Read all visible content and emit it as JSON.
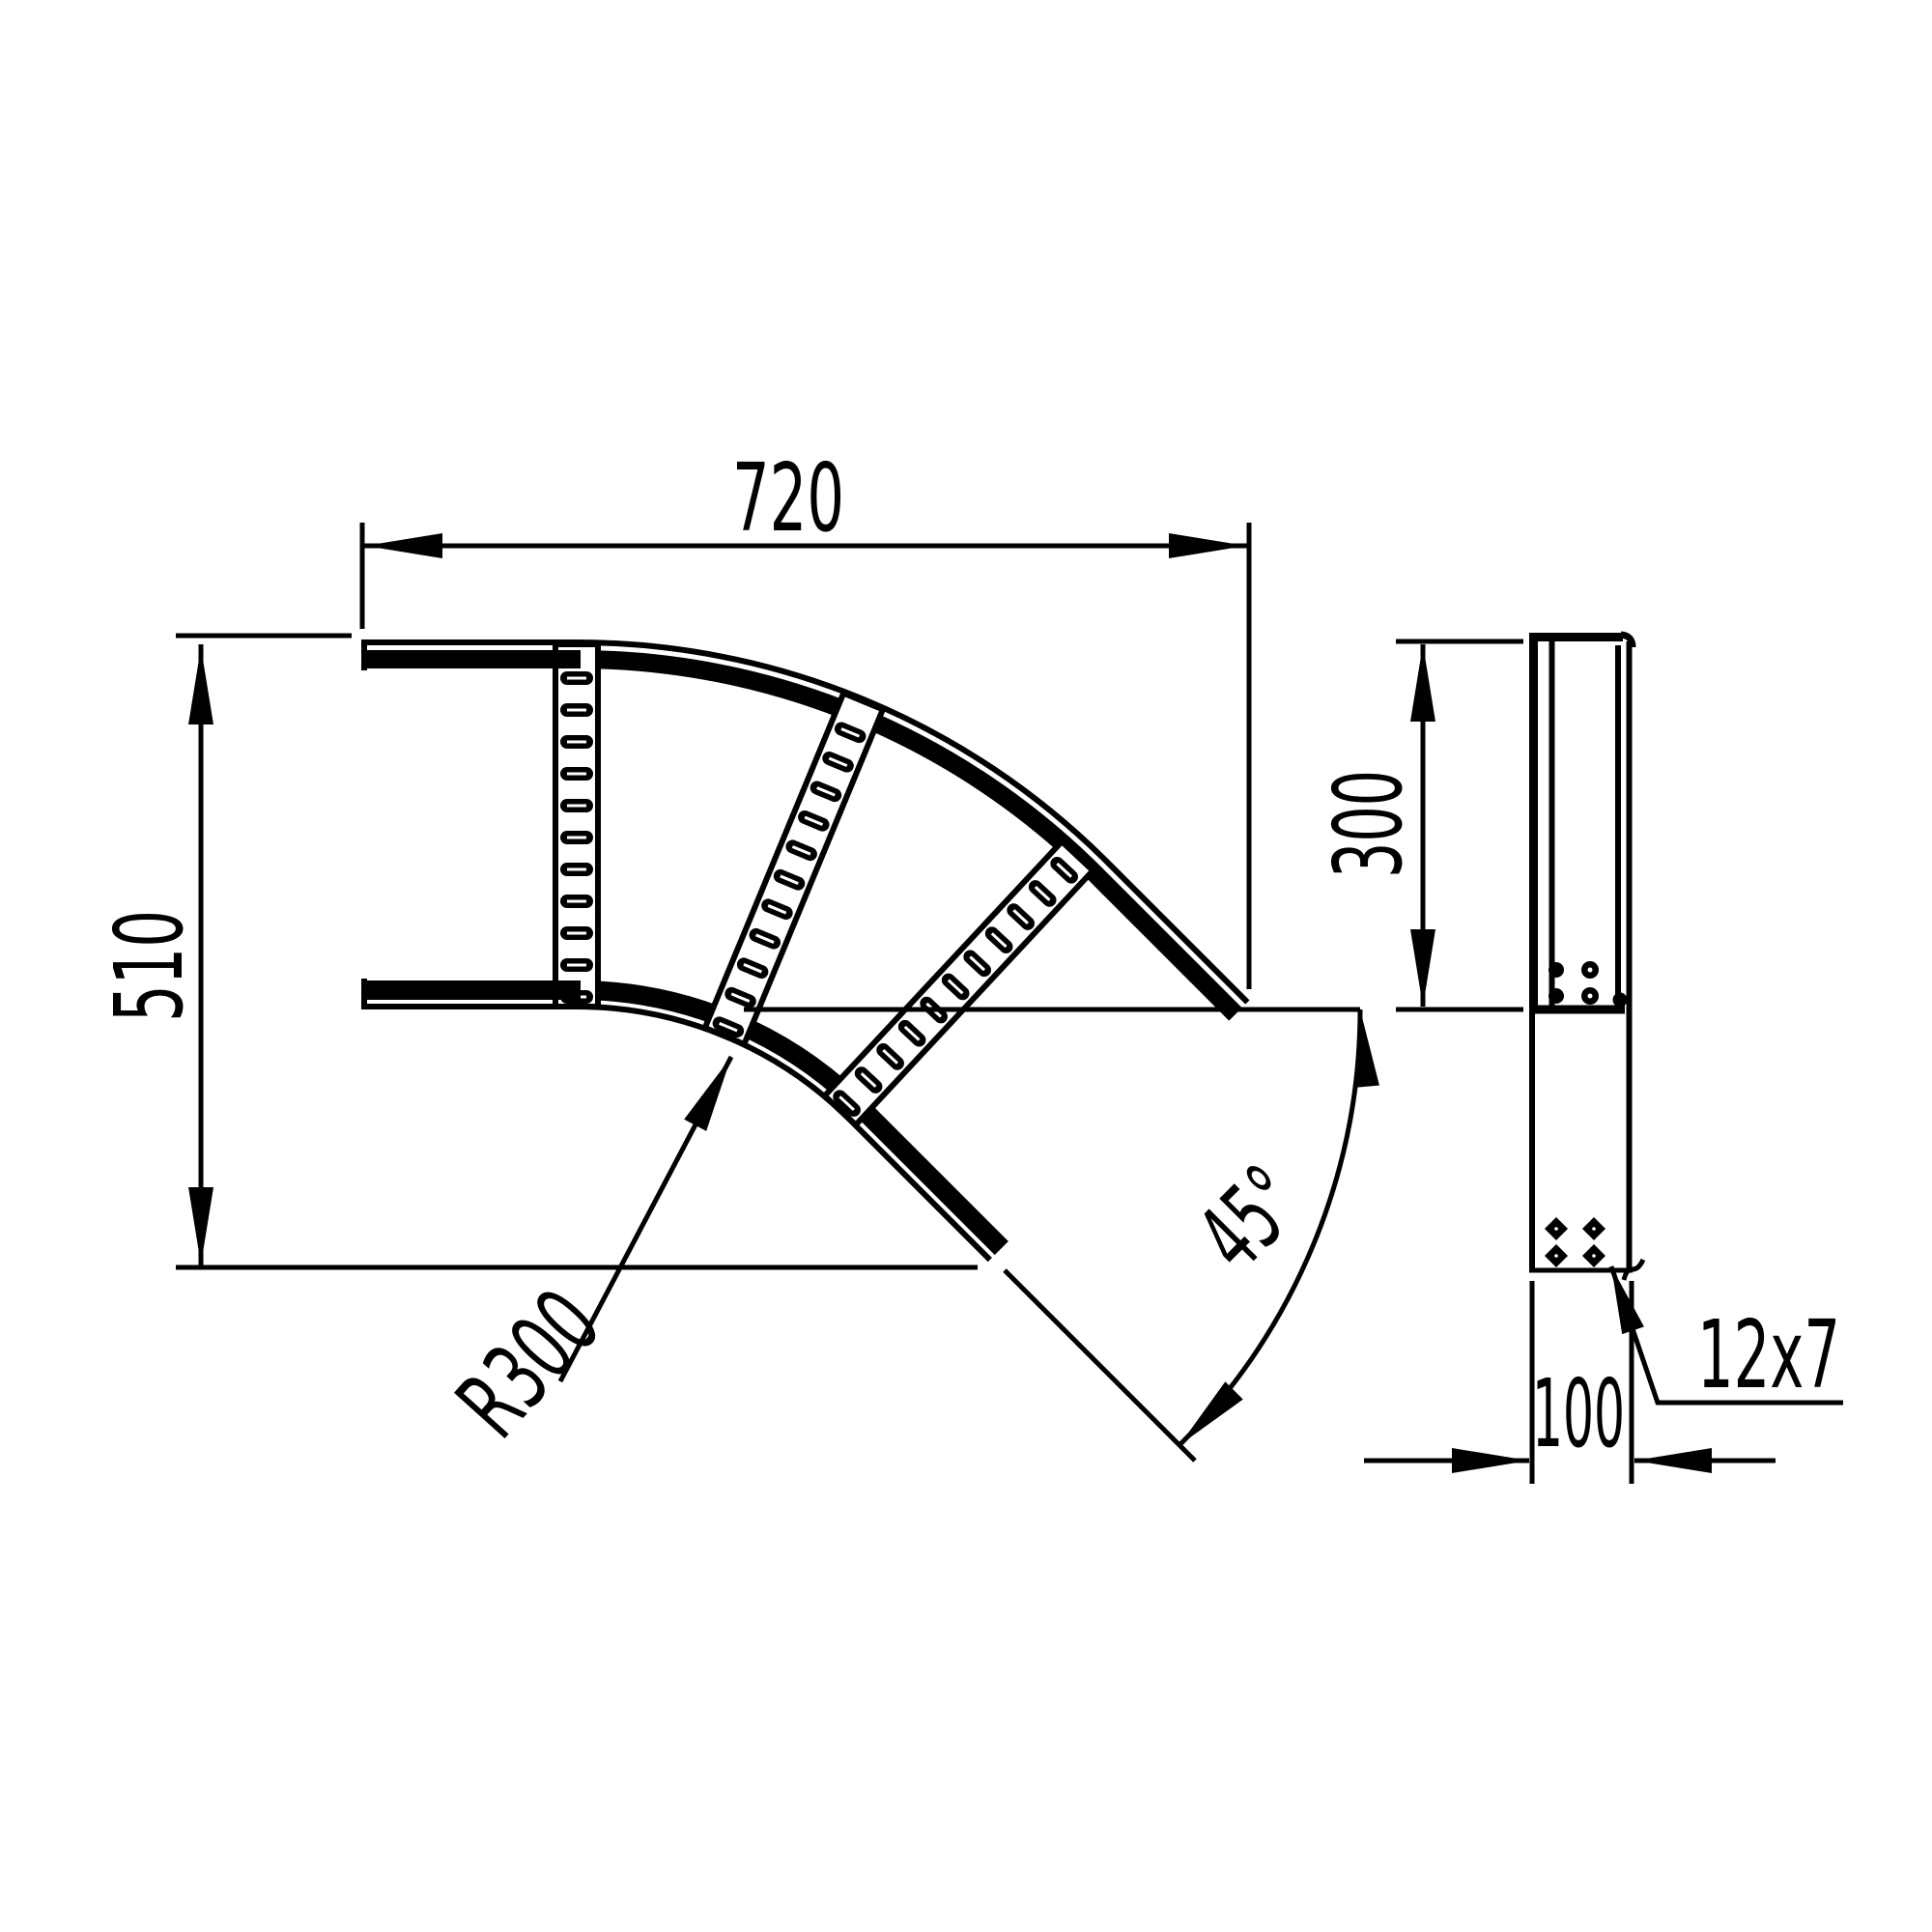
{
  "drawing": {
    "title": "cable-ladder-45-degree-bend",
    "background_color": "#ffffff",
    "line_color": "#000000",
    "views": {
      "plan_view": {
        "dimensions": {
          "width": "720",
          "height": "510",
          "bend_radius": "R300",
          "bend_angle": "45°"
        }
      },
      "side_view": {
        "dimensions": {
          "rail_width": "300",
          "profile_width": "100",
          "slot_size": "12x7"
        }
      }
    }
  }
}
